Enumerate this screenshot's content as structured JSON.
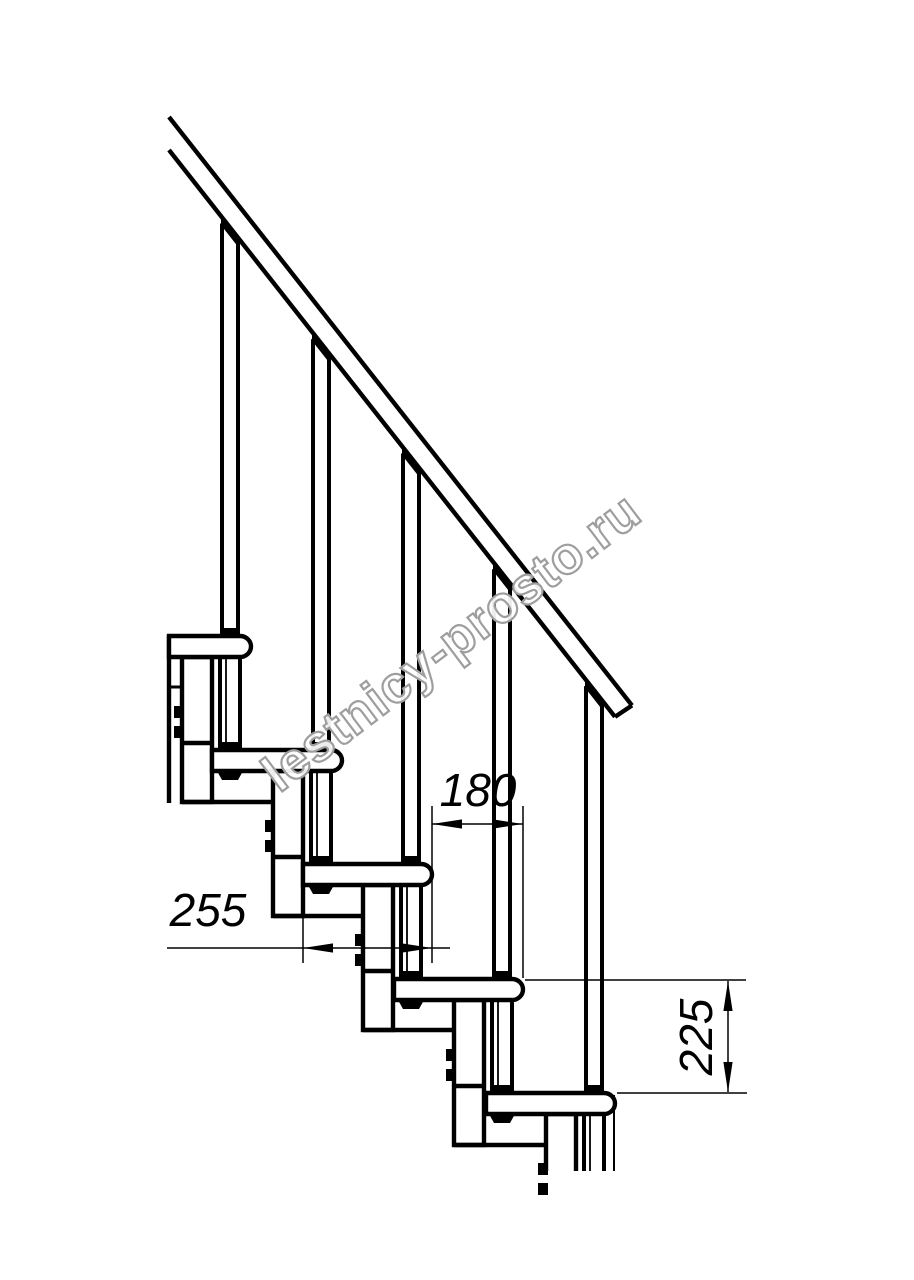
{
  "page": {
    "width": 914,
    "height": 1280,
    "background": "#ffffff"
  },
  "watermark": {
    "text": "lestnicy-prosto.ru",
    "angle_deg": -37,
    "cx": 462,
    "cy": 656,
    "font_size": 52,
    "outline_color": "#9e9e9e",
    "fill_color": "#ffffff",
    "fill_opacity": 0.93,
    "stroke_width": 2.2
  },
  "drawing": {
    "ink": "#000000",
    "bg": "#ffffff",
    "thick": 4.4,
    "mid": 3,
    "thin": 1.5,
    "treads": {
      "tops": [
        636,
        750,
        864,
        979,
        1093
      ],
      "lefts": [
        169,
        212,
        303,
        394,
        486
      ],
      "rights": [
        251,
        342,
        432,
        523,
        615
      ],
      "thickness": 21,
      "nose_radius": 11
    },
    "balusters": {
      "width": 16,
      "axis_offset": 21,
      "foot_w": 22,
      "cap_h": 8
    },
    "rods": {
      "width": 20
    },
    "rail": {
      "x0": 169,
      "top_y0": 117,
      "under_y0": 150,
      "slope": 1.2709,
      "under_x1": 615,
      "top_x1": 632
    },
    "modules": {
      "col_left": 69,
      "col_right": 39,
      "bottom": 166,
      "divider": 107,
      "connector_right_ext": 22,
      "bolt_w": 10,
      "bolt_h": 12,
      "bolt_y1": 70,
      "bolt_y2": 90
    },
    "cut_y": 1171,
    "extra_lines": [
      [
        169,
        636,
        169,
        803,
        4.4
      ],
      [
        169,
        687,
        182,
        687,
        3
      ],
      [
        614,
        1095,
        614,
        1171,
        2
      ]
    ]
  },
  "dimensions": {
    "run": {
      "label": "180",
      "y": 824,
      "x1": 432,
      "x2": 523,
      "text_x": 478,
      "text_y": 806,
      "ext": [
        [
          432,
          806,
          432,
          963
        ],
        [
          523,
          806,
          523,
          978
        ]
      ]
    },
    "depth": {
      "label": "255",
      "y": 948,
      "x1": 303,
      "x2": 432,
      "line_x1": 167,
      "line_x2": 450,
      "text_x": 208,
      "text_y": 926,
      "ext": [
        [
          303,
          916,
          303,
          963
        ]
      ]
    },
    "rise": {
      "label": "225",
      "x": 728,
      "y1": 981,
      "y2": 1092,
      "text_x": 712,
      "text_y": 1037,
      "ext": [
        [
          525,
          980,
          746,
          980
        ],
        [
          617,
          1093,
          747,
          1093
        ]
      ]
    }
  }
}
